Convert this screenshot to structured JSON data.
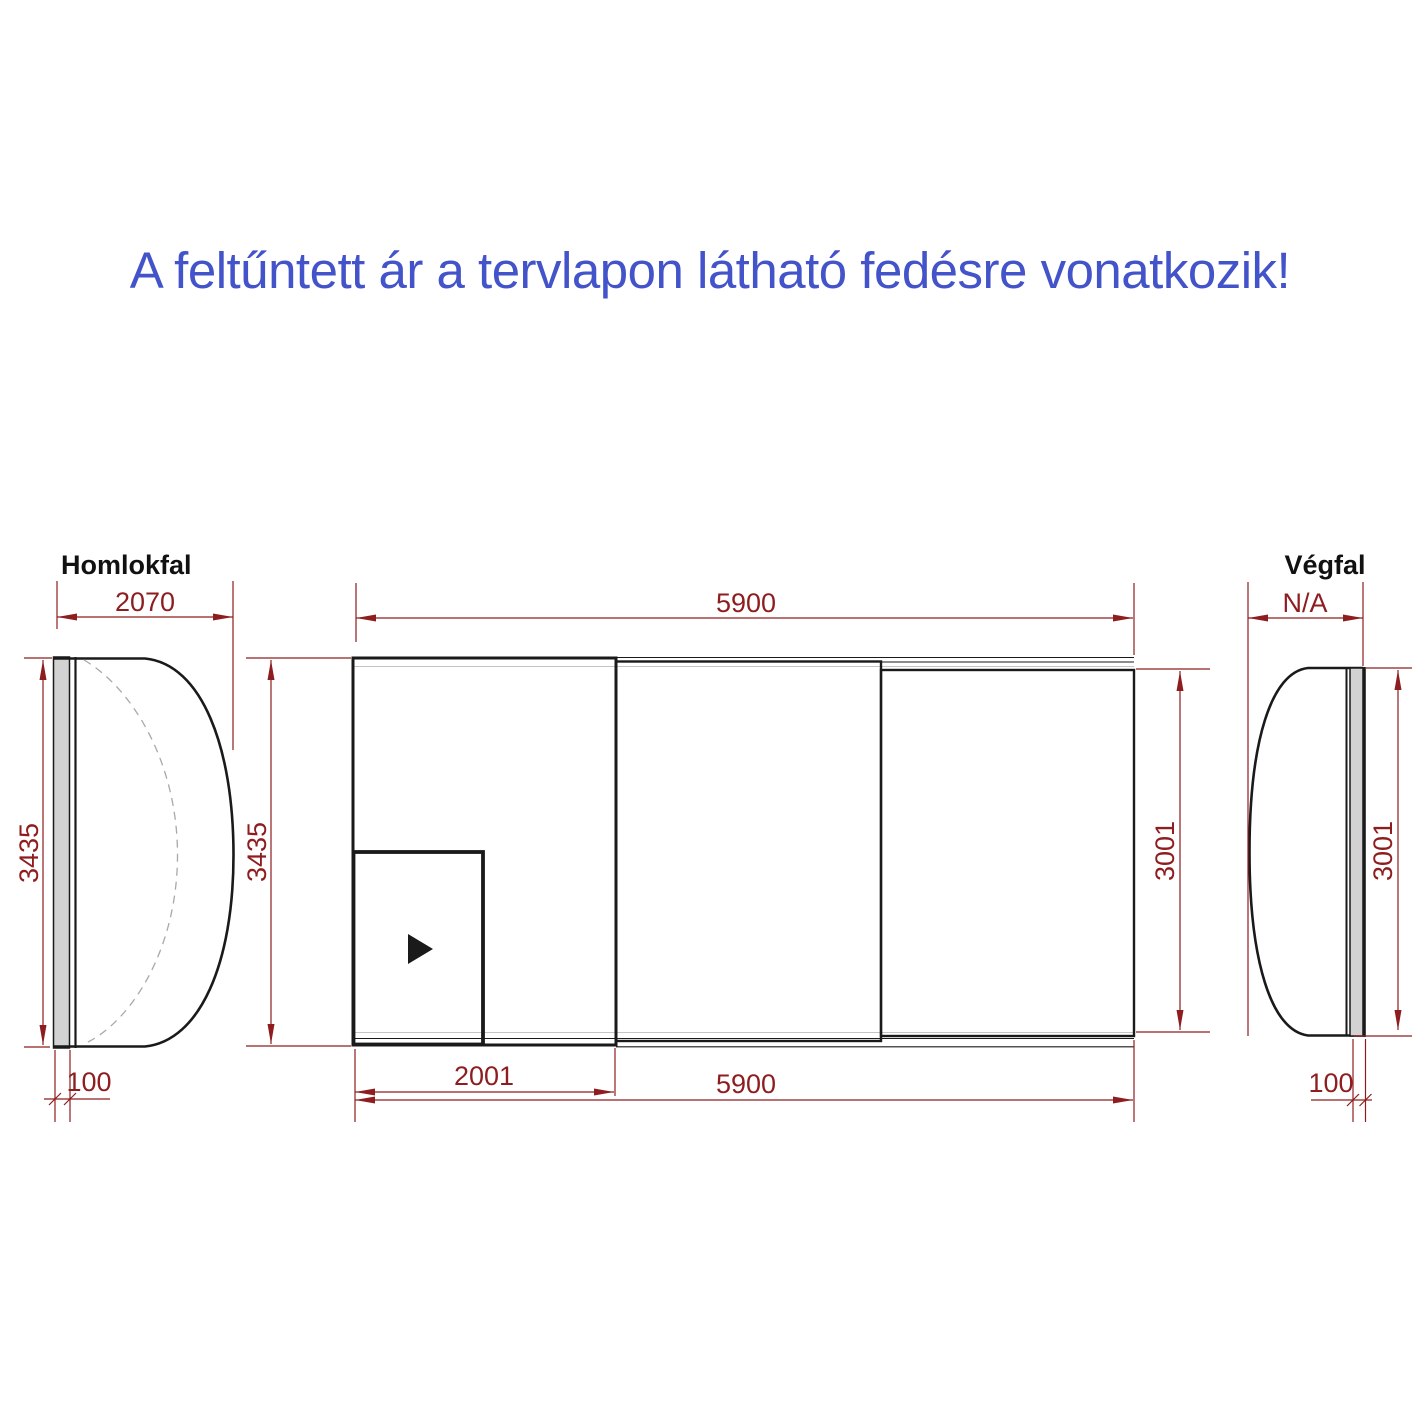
{
  "headline": {
    "text": "A feltűntett ár a tervlapon látható fedésre vonatkozik!",
    "color": "#4353c9"
  },
  "colors": {
    "dimension_red": "#8e1d1f",
    "line_black": "#1a1a1a",
    "wall_gray": "#d2d2d2",
    "dashed_gray": "#a8a8a8"
  },
  "front_wall_view": {
    "title": "Homlokfal",
    "width_dim": "2070",
    "height_dim": "3435",
    "wall_thickness_dim": "100"
  },
  "plan_view": {
    "top_length_dim": "5900",
    "left_height_dim": "3435",
    "right_height_dim": "3001",
    "door_width_dim": "2001",
    "bottom_length_dim": "5900",
    "door_arrow_icon": "right-triangle"
  },
  "end_wall_view": {
    "title": "Végfal",
    "width_dim": "N/A",
    "height_dim": "3001",
    "wall_thickness_dim": "100"
  }
}
